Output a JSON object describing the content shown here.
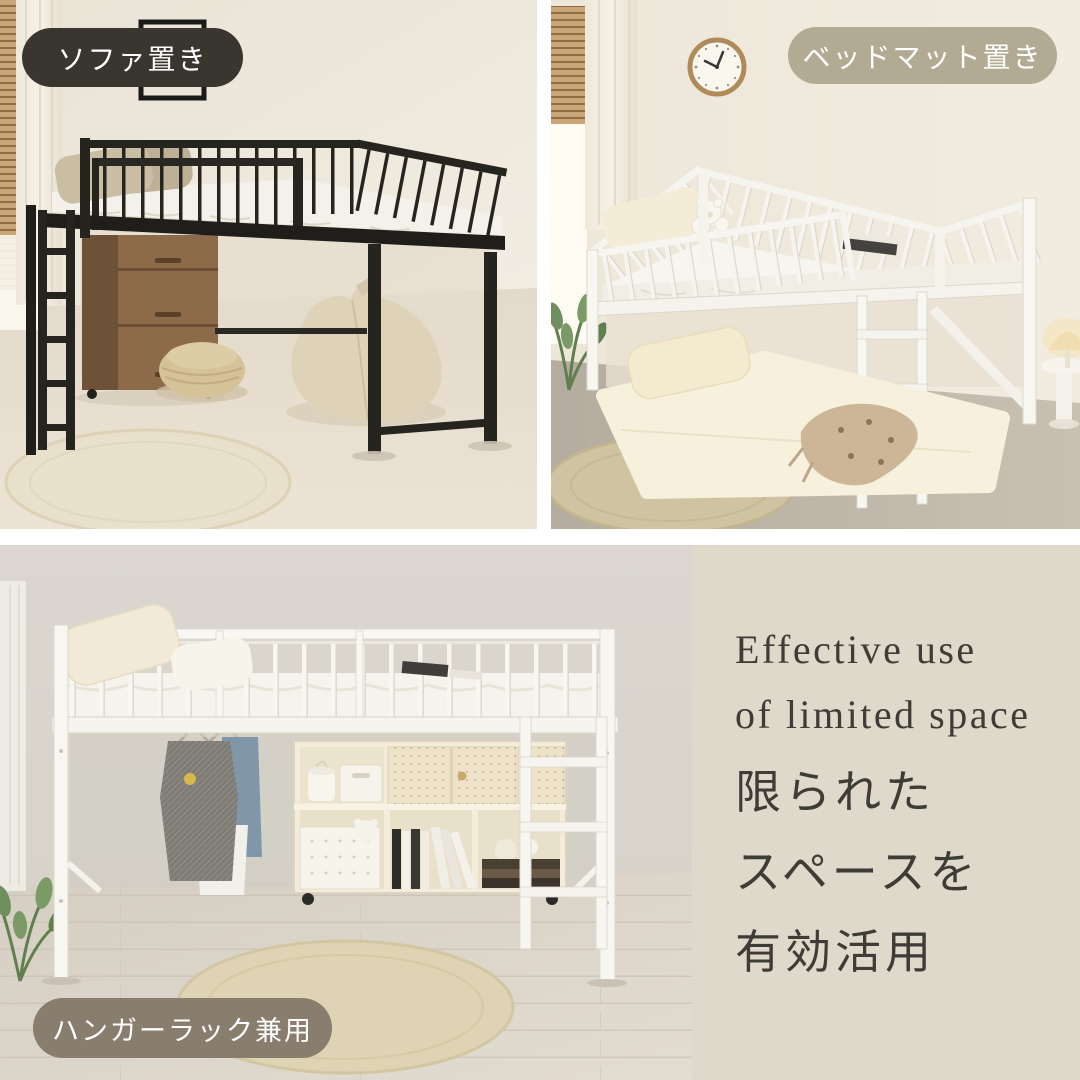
{
  "badges": {
    "sofa": {
      "label": "ソファ置き"
    },
    "bedmat": {
      "label": "ベッドマット置き"
    },
    "hanger": {
      "label": "ハンガーラック兼用"
    }
  },
  "panel": {
    "en1": "Effective use",
    "en2": "of limited space",
    "jp1": "限られた",
    "jp2": "スペースを",
    "jp3": "有効活用"
  },
  "colors": {
    "pill-dark": "#39362f",
    "pill-beige": "#b2aa92",
    "pill-taupe": "#897d6d",
    "pill-text": "#ffffff",
    "panel-bg": "#ded9ca",
    "ink": "#3e3c36",
    "bed-black": "#26241f",
    "bed-white": "#f7f5f0",
    "divider": "#ffffff"
  }
}
